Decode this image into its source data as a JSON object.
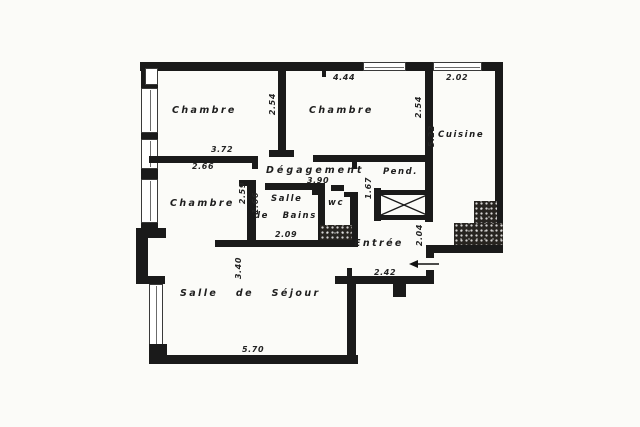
{
  "title": "apartment-floor-plan",
  "colors": {
    "ink": "#1a1a1a",
    "paper": "#fbfbf8",
    "text": "#1e1e1e"
  },
  "rooms": {
    "chambre_top_left": "Chambre",
    "chambre_top_middle": "Chambre",
    "chambre_left": "Chambre",
    "cuisine": "Cuisine",
    "degagement": "Dégagement",
    "salle_de_bains_line1": "Salle",
    "salle_de_bains_line2": "de  Bains",
    "wc": "wc",
    "penderie": "Pend.",
    "entree": "Entrée",
    "salle_de_sejour": "Salle  de  Séjour"
  },
  "dimensions": {
    "top_span": "4.44",
    "cuisine_width": "2.02",
    "chambre_top_left_width": "3.72",
    "chambre_left_width": "2.66",
    "chambre_divider_depth": "2.54",
    "chambre_middle_depth": "2.54",
    "cuisine_depth": "5.22",
    "degagement_length": "3.90",
    "bains_outer_depth": "2.59",
    "bains_inner_depth": "1.66",
    "bains_width": "2.09",
    "penderie_width": "1.67",
    "entree_depth": "2.04",
    "entree_width": "2.42",
    "sejour_depth": "3.40",
    "sejour_width": "5.70"
  }
}
